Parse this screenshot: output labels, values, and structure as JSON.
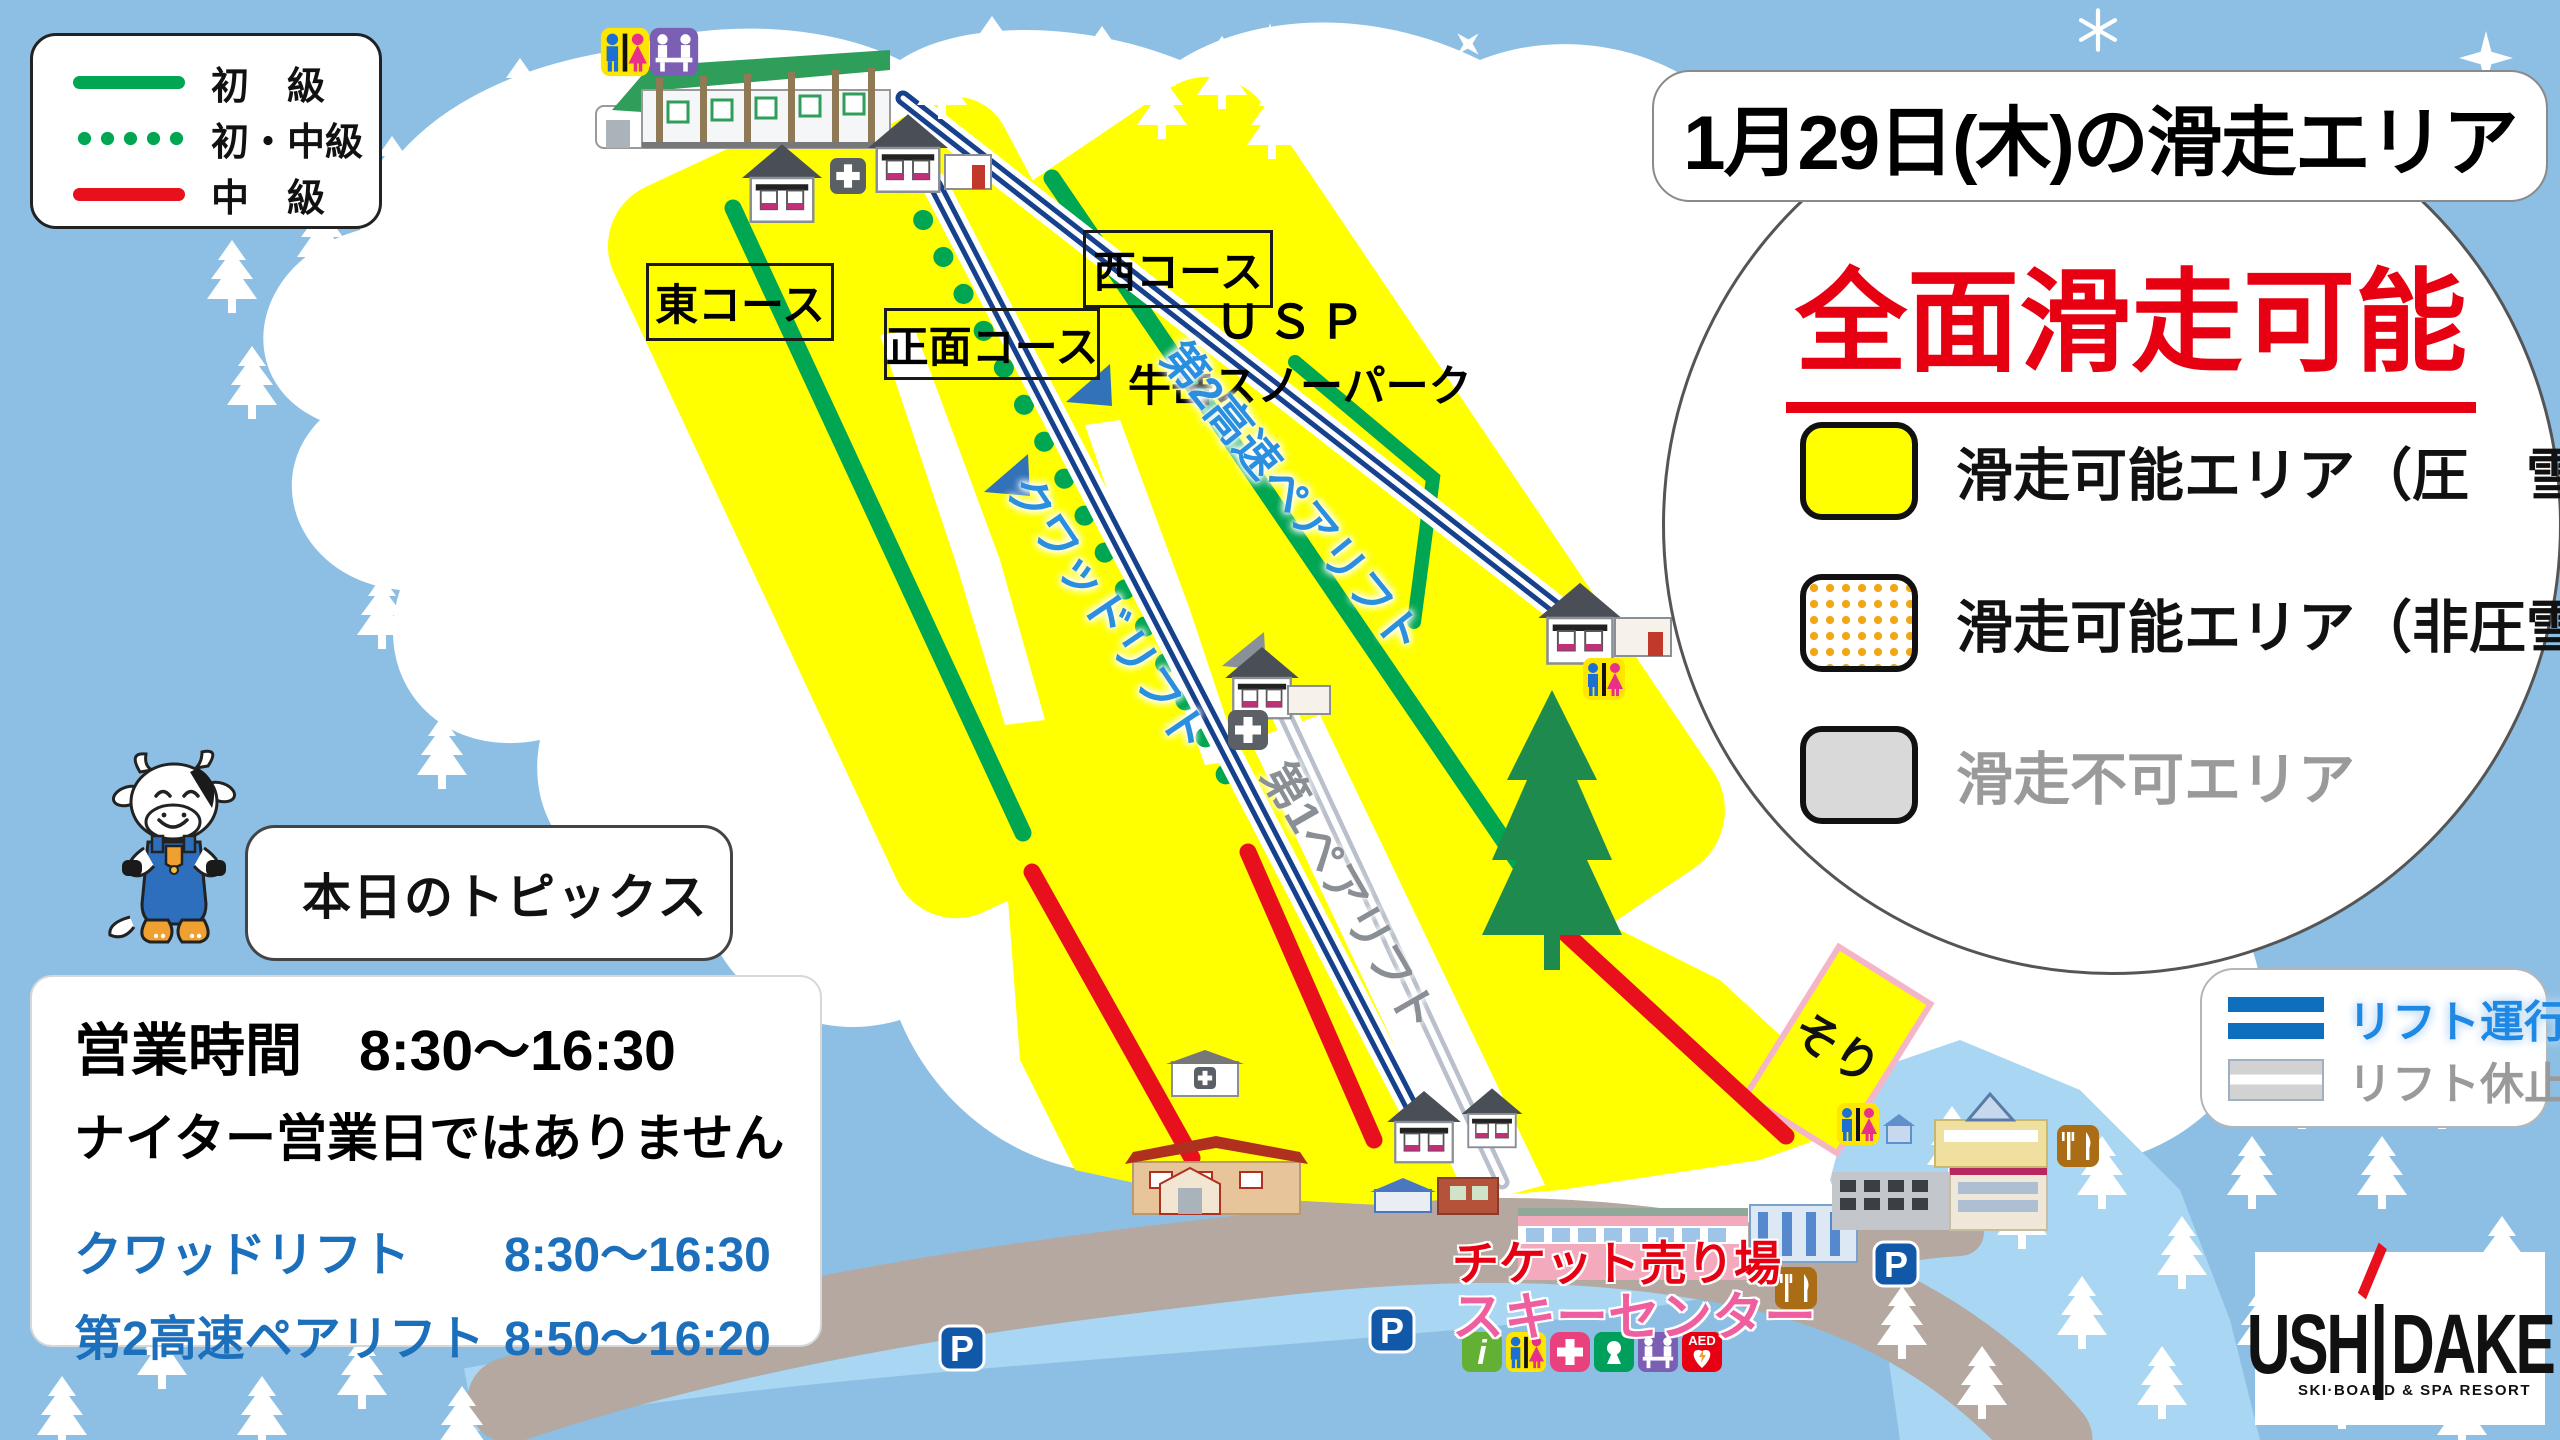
{
  "course_legend": {
    "beginner_label": "初　級",
    "beginner_intermediate_label": "初・中級",
    "intermediate_label": "中　級"
  },
  "title_box": {
    "text": "1月29日(木)の滑走エリア"
  },
  "status_circle": {
    "headline": "全面滑走可能",
    "groomed_label": "滑走可能エリア（圧　雪）",
    "ungroomed_label": "滑走可能エリア（非圧雪）",
    "closed_label": "滑走不可エリア"
  },
  "topics_box": {
    "label": "本日のトピックス"
  },
  "hours_panel": {
    "business_hours": "営業時間　8:30～16:30",
    "night_notice": "ナイター営業日ではありません",
    "quad_lift_name": "クワッドリフト",
    "quad_lift_time": "8:30～16:30",
    "pair2_lift_name": "第2高速ペアリフト",
    "pair2_lift_time": "8:50～16:20"
  },
  "lift_status_legend": {
    "running_label": "リフト運行",
    "stopped_label": "リフト休止"
  },
  "map": {
    "course_east": "東コース",
    "course_front": "正面コース",
    "course_west": "西コース",
    "park_name_line1": "ＵＳＰ",
    "park_name_line2": "牛岳スノーパーク",
    "lift_quad": "クワッドリフト",
    "lift_pair2": "第2高速ペアリフト",
    "lift_pair1": "第1ペアリフト",
    "sled_area": "そり",
    "ticket_office": "チケット売り場",
    "ski_center": "スキーセンター",
    "parking_letter": "P",
    "aed_label": "AED",
    "info_letter": "i"
  },
  "logo": {
    "name_left": "USH",
    "name_right": "DAKE",
    "tagline": "SKI·BOARD & SPA RESORT"
  },
  "colors": {
    "beginner_green": "#00a651",
    "intermediate_red": "#e8101c",
    "skiable_yellow": "#ffff00",
    "ungroomed_dot_orange": "#f0a818",
    "closed_gray": "#d9d9d9",
    "lift_running_blue": "#0d6fbd",
    "lift_stopped_gray": "#b9c0cc",
    "headline_red": "#e60012",
    "sky_blue": "#8cbfe3"
  }
}
